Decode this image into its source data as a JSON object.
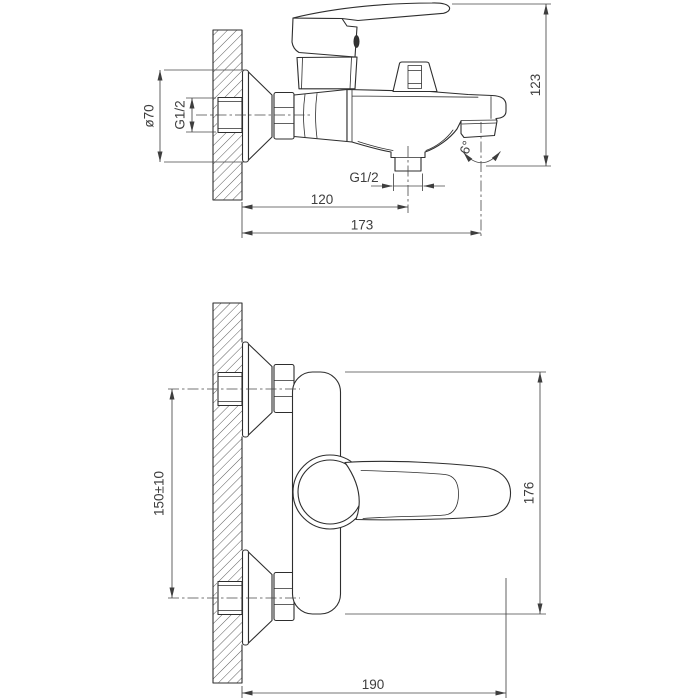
{
  "colors": {
    "background": "#ffffff",
    "object_line": "#2e2e2e",
    "dimension_line": "#474747",
    "text": "#3e3e3e"
  },
  "side_view": {
    "dims": {
      "flange_diameter": "ø70",
      "inlet_thread": "G1/2",
      "overall_height": "123",
      "spout_angle": "6°",
      "shower_thread": "G1/2",
      "wall_to_shower_outlet": "120",
      "wall_to_spout": "173"
    }
  },
  "front_view": {
    "dims": {
      "inlet_spacing": "150±10",
      "body_height": "176",
      "wall_to_handle_end": "190"
    }
  }
}
